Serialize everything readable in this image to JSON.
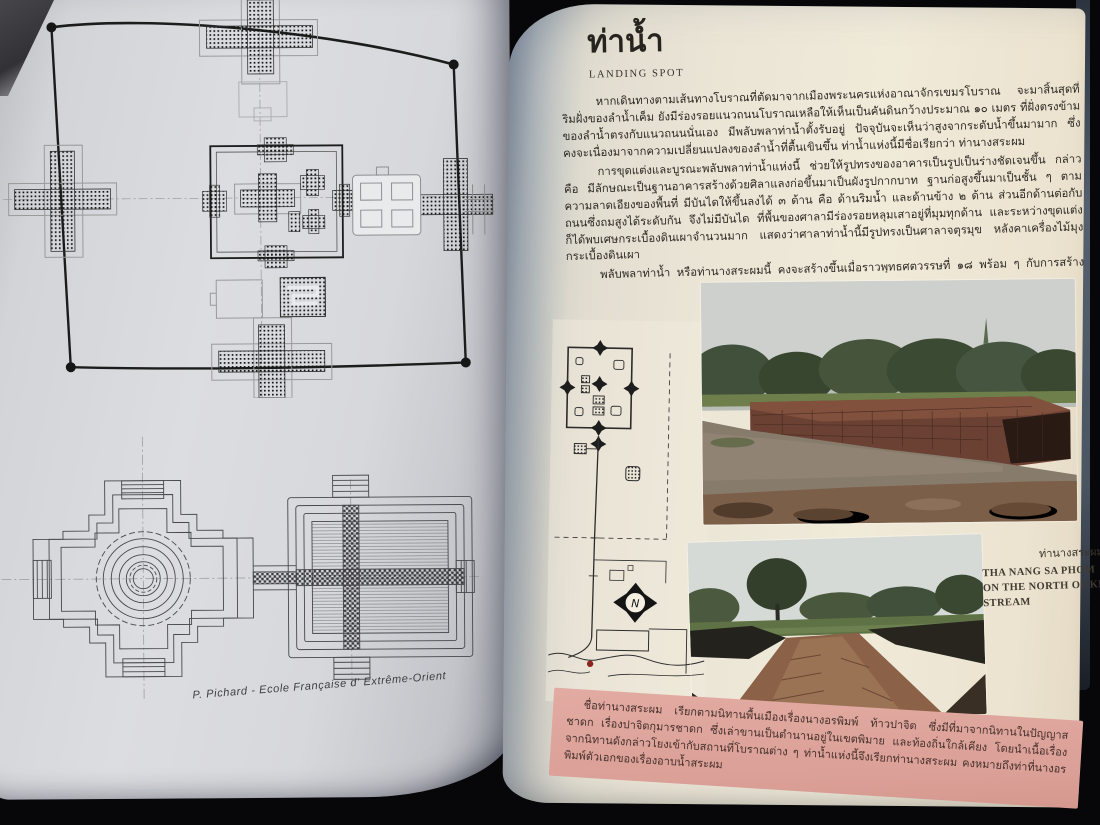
{
  "left_page": {
    "caption": "P. Pichard - Ecole Française d' Extrême-Orient",
    "drawings": {
      "site_plan_name": "temple-town-site-plan",
      "platform_plan_name": "cruciform-terrace-plan"
    }
  },
  "right_page": {
    "title": "ท่าน้ำ",
    "subtitle": "LANDING SPOT",
    "paragraphs": [
      "หากเดินทางตามเส้นทางโบราณที่ตัดมาจากเมืองพระนครแห่งอาณาจักรเขมรโบราณ จะมาสิ้นสุดที่ริมฝั่งของลำน้ำเค็ม ยังมีร่องรอยแนวถนนโบราณเหลือให้เห็นเป็นคันดินกว้างประมาณ ๑๐ เมตร ที่ฝั่งตรงข้ามของลำน้ำตรงกับแนวถนนนั่นเอง มีพลับพลาท่าน้ำตั้งรับอยู่ ปัจจุบันจะเห็นว่าสูงจากระดับน้ำขึ้นมามาก ซึ่งคงจะเนื่องมาจากความเปลี่ยนแปลงของลำน้ำที่ตื้นเขินขึ้น ท่าน้ำแห่งนี้มีชื่อเรียกว่า ท่านางสระผม",
      "การขุดแต่งและบูรณะพลับพลาท่าน้ำแห่งนี้ ช่วยให้รูปทรงของอาคารเป็นรูปเป็นร่างชัดเจนขึ้น กล่าวคือ มีลักษณะเป็นฐานอาคารสร้างด้วยศิลาแลงก่อขึ้นมาเป็นผังรูปกากบาท ฐานก่อสูงขึ้นมาเป็นชั้น ๆ ตามความลาดเอียงของพื้นที่ มีบันไดให้ขึ้นลงได้ ๓ ด้าน คือ ด้านริมน้ำ และด้านข้าง ๒ ด้าน ส่วนอีกด้านต่อกับถนนซึ่งถมสูงได้ระดับกัน จึงไม่มีบันได ที่พื้นของศาลามีร่องรอยหลุมเสาอยู่ที่มุมทุกด้าน และระหว่างขุดแต่งก็ได้พบเศษกระเบื้องดินเผาจำนวนมาก แสดงว่าศาลาท่าน้ำนี้มีรูปทรงเป็นศาลาจตุรมุข หลังคาเครื่องไม้มุงกระเบื้องดินเผา",
      "พลับพลาท่าน้ำ หรือท่านางสระผมนี้ คงจะสร้างขึ้นเมื่อราวพุทธศตวรรษที่ ๑๘ พร้อม ๆ กับการสร้างประตูกำแพงเมือง"
    ],
    "photo_caption": {
      "thai": "ท่านางสระผม",
      "en_lines": [
        "THA NANG SA PHOM",
        "ON THE NORTH OF KHEM",
        "STREAM"
      ]
    },
    "note_box": {
      "text": "ชื่อท่านางสระผม เรียกตามนิทานพื้นเมืองเรื่องนางอรพิมพ์ ท้าวปาจิต ซึ่งมีที่มาจากนิทานในปัญญาสชาดก เรื่องปาจิตกุมารชาดก ซึ่งเล่าขานเป็นตำนานอยู่ในเขตพิมาย และท้องถิ่นใกล้เคียง โดยนำเนื้อเรื่องจากนิทานดังกล่าวโยงเข้ากับสถานที่โบราณต่าง ๆ ท่าน้ำแห่งนี้จึงเรียกท่านางสระผม คงหมายถึงท่าที่นางอรพิมพ์ตัวเอกของเรื่องอาบน้ำสระผม",
      "background_color": "#dfa69d"
    },
    "map": {
      "compass_label": "N",
      "marker_color": "#8e2420"
    }
  },
  "colors": {
    "table_background": "#07070a",
    "left_paper": "#d8d9dd",
    "right_paper": "#efe8d8",
    "ink": "#1e1c1a",
    "note_pink": "#dfa69d"
  }
}
